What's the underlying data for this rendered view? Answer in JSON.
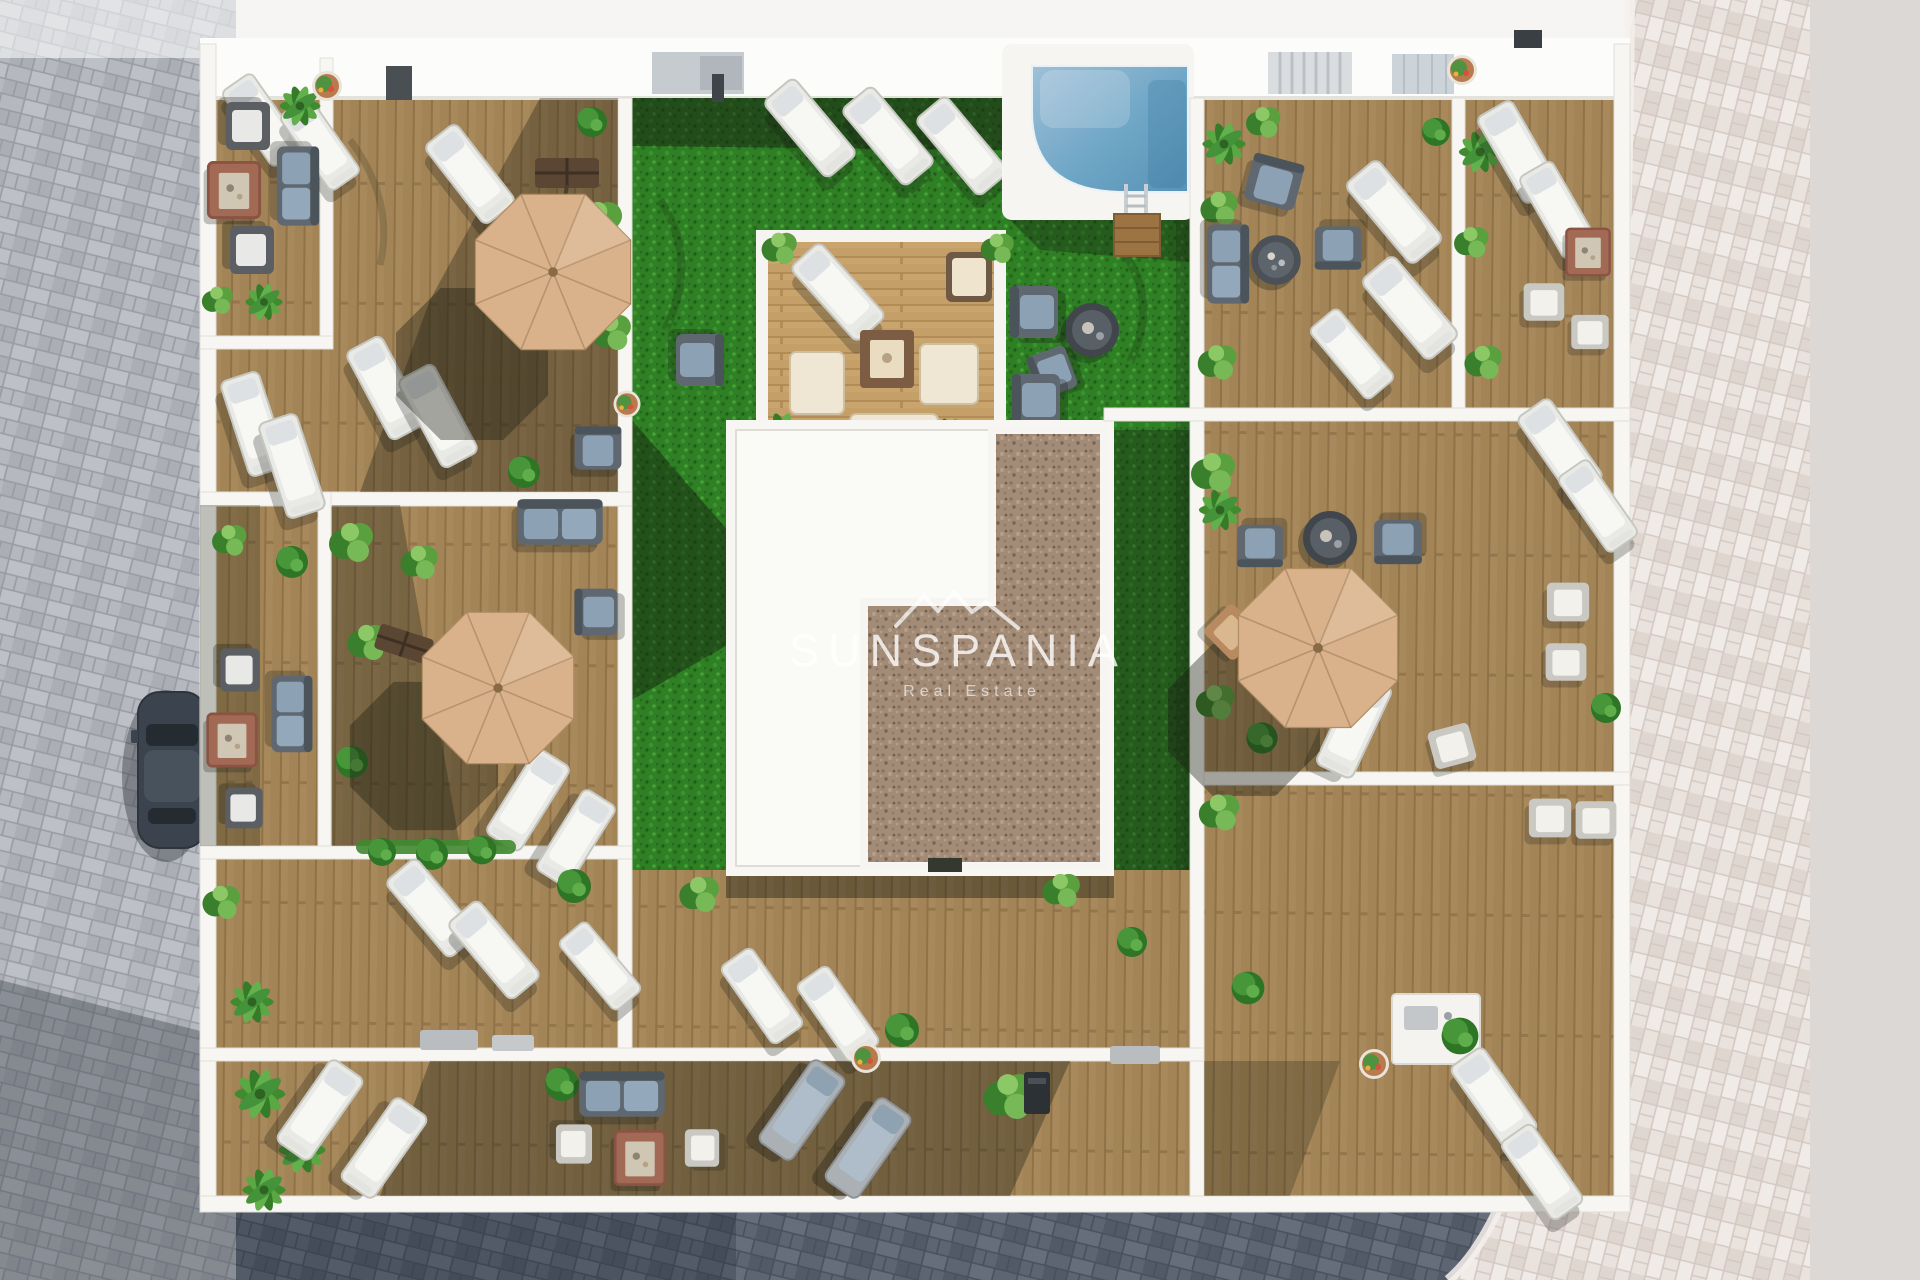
{
  "scene": {
    "title": "Aerial 3D render of a communal rooftop terrace",
    "watermark": {
      "brand": "SUNSPANIA",
      "tagline": "Real Estate",
      "logo": "mountain-ridge-icon"
    },
    "elements": [
      "swimming pool with chrome ladder and wooden steps",
      "artificial grass lawn with sun loungers",
      "central wooden lounge platform with fire table and cream cushions",
      "white building roof with brown gravel roof section",
      "four tan cantilever parasols over private wood-deck terraces",
      "white sun loungers and blue-grey outdoor sofas and armchairs",
      "red-brown fire pit tables",
      "potted plants, bushes and palm planters",
      "dark car parked on grey paver street",
      "grey, dark-slate and pink paver streets around the building"
    ]
  },
  "palette": {
    "street_gray": "#b5b8be",
    "street_dark": "#5d6572",
    "street_light": "#eae2dd",
    "street_flat": "#dbd8d6",
    "deck_wood": "#a8895c",
    "platform_wood": "#c9a46d",
    "grass": "#2f8024",
    "gravel": "#a28b77",
    "wall": "#f7f6f2",
    "pool_light": "#9fc0d8",
    "pool_mid": "#6fa6c6",
    "pool_deep": "#5892b6",
    "umbrella": "#d9b28b",
    "lounger_white": "#f7f7f4",
    "cushion_blue": "#8ca1b3",
    "fire_table": "#a26a55",
    "car": "#3b444e",
    "watermark_white": "#ffffff"
  }
}
